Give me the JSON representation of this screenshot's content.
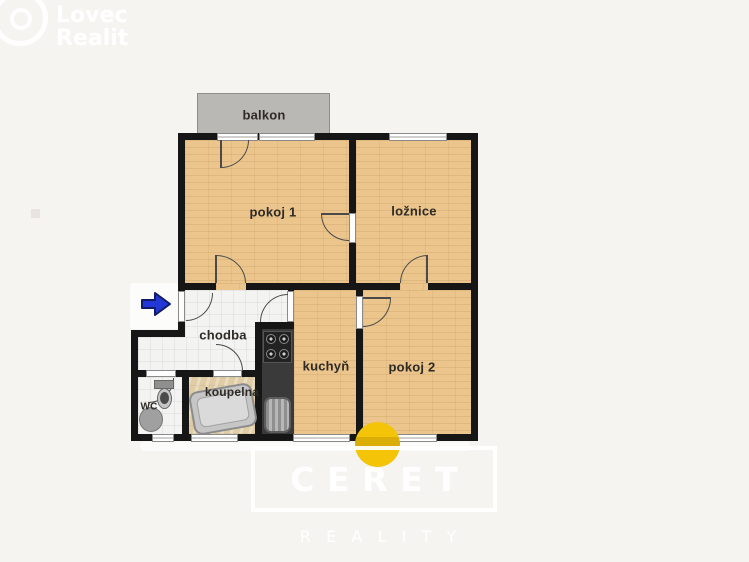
{
  "branding": {
    "logo": {
      "line1": "Lovec",
      "line2": "Realit"
    },
    "watermark": {
      "title": "CERET",
      "subtitle": "REALITY"
    }
  },
  "floorplan": {
    "rooms": [
      {
        "id": "balkon",
        "label": "balkon"
      },
      {
        "id": "pokoj1",
        "label": "pokoj 1"
      },
      {
        "id": "loznice",
        "label": "ložnice"
      },
      {
        "id": "chodba",
        "label": "chodba"
      },
      {
        "id": "kuchyn",
        "label": "kuchyň"
      },
      {
        "id": "pokoj2",
        "label": "pokoj 2"
      },
      {
        "id": "koupelna",
        "label": "koupelna"
      },
      {
        "id": "wc",
        "label": "WC"
      }
    ],
    "entry": {
      "direction": "right"
    },
    "colors": {
      "wall": "#161616",
      "wood_floor": "#ebc58c",
      "tile_floor": "#f3f3f1",
      "bath_floor": "#e0cda6",
      "balcony": "#bab8b5",
      "counter": "#3a3a3a",
      "entry_arrow": "#2336d6",
      "accent_dot": "#f3c408",
      "background": "#f6f4f1"
    }
  }
}
